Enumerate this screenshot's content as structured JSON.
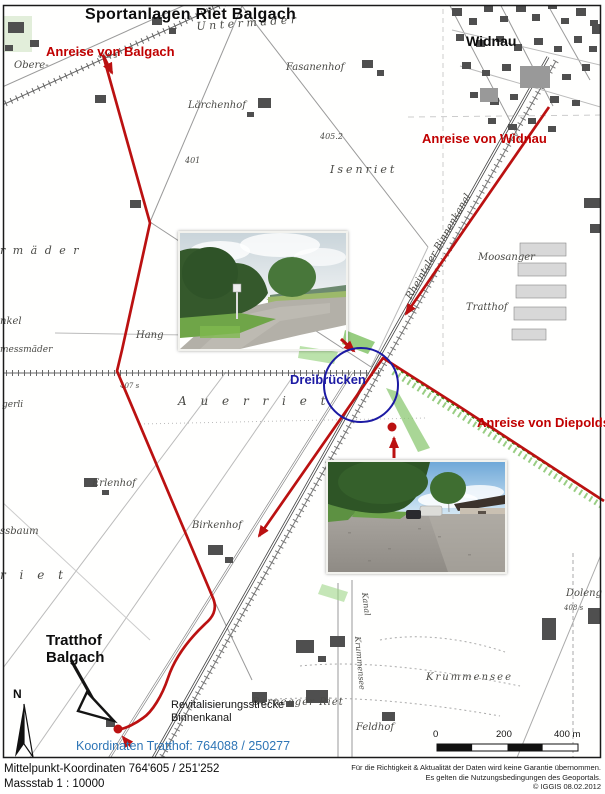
{
  "title": "Sportanlagen Riet Balgach",
  "annotations": {
    "anreise_balgach": "Anreise von Balgach",
    "anreise_widnau": "Anreise von Widnau",
    "anreise_diepoldsau": "Anreise von Diepoldsau",
    "widnau": "Widnau",
    "dreibruecken": "Dreibrücken",
    "tratthof_line1": "Tratthof",
    "tratthof_line2": "Balgach",
    "revital_line1": "Revitalisierungsstrecke",
    "revital_line2": "Binnenkanal",
    "koordinaten_tratthof": "Koordinaten Tratthof: 764088 / 250277",
    "compass": "N"
  },
  "scale_bar": {
    "tick_0": "0",
    "tick_200": "200",
    "tick_400": "400 m"
  },
  "footer": {
    "center_coordinates": "Mittelpunkt-Koordinaten 764'605 / 251'252",
    "scale": "Massstab 1 : 10000",
    "disclaimer_line1": "Für die Richtigkeit & Aktualität der Daten wird keine Garantie übernommen.",
    "disclaimer_line2": "Es gelten die Nutzungsbedingungen des Geoportals.",
    "credit": "© IGGIS  08.02.2012"
  },
  "colors": {
    "route_red": "#bb1111",
    "label_red": "#c00000",
    "circle_blue": "#1c1aa3",
    "coordinates_blue": "#2e75b6"
  },
  "map_labels": [
    {
      "t": "U n t e r m ä d e r",
      "x": 196,
      "y": 20,
      "s": 11,
      "r": -4
    },
    {
      "t": "Obere-",
      "x": 14,
      "y": 60,
      "s": 10
    },
    {
      "t": "Fasanenhof",
      "x": 286,
      "y": 62,
      "s": 10
    },
    {
      "t": "Lärchenhof",
      "x": 188,
      "y": 100,
      "s": 10
    },
    {
      "t": "Isenriet",
      "x": 330,
      "y": 163,
      "s": 11,
      "ls": 3
    },
    {
      "t": "r m ä d e r",
      "x": 0,
      "y": 244,
      "s": 11,
      "ls": 2
    },
    {
      "t": "nkel",
      "x": 0,
      "y": 316,
      "s": 10
    },
    {
      "t": "messmäder",
      "x": 0,
      "y": 345,
      "s": 9
    },
    {
      "t": "Hang",
      "x": 136,
      "y": 330,
      "s": 10
    },
    {
      "t": "gerli",
      "x": 2,
      "y": 400,
      "s": 9
    },
    {
      "t": "A u e r r i e t",
      "x": 178,
      "y": 394,
      "s": 12,
      "ls": 5
    },
    {
      "t": "Moosanger",
      "x": 478,
      "y": 252,
      "s": 10
    },
    {
      "t": "Tratthof",
      "x": 466,
      "y": 302,
      "s": 10
    },
    {
      "t": "Rheintaler Binnenkanal",
      "x": 404,
      "y": 296,
      "s": 10,
      "r": -60
    },
    {
      "t": "Erlenhof",
      "x": 92,
      "y": 478,
      "s": 10
    },
    {
      "t": "ssbaum",
      "x": 0,
      "y": 526,
      "s": 10
    },
    {
      "t": "Birkenhof",
      "x": 192,
      "y": 520,
      "s": 10
    },
    {
      "t": "r i e t",
      "x": 0,
      "y": 568,
      "s": 12,
      "ls": 5
    },
    {
      "t": "Krummensee",
      "x": 426,
      "y": 672,
      "s": 10,
      "ls": 2
    },
    {
      "t": "Doleng",
      "x": 566,
      "y": 588,
      "s": 10
    },
    {
      "t": "Bernegger  Riet",
      "x": 252,
      "y": 697,
      "s": 10,
      "ls": 1
    },
    {
      "t": "Feldhof",
      "x": 356,
      "y": 722,
      "s": 10
    },
    {
      "t": "Kanal",
      "x": 369,
      "y": 592,
      "s": 8,
      "r": 83
    },
    {
      "t": "Krummensee",
      "x": 362,
      "y": 636,
      "s": 8,
      "r": 85
    },
    {
      "t": "406 s",
      "x": 98,
      "y": 52,
      "s": 7
    },
    {
      "t": "401",
      "x": 185,
      "y": 156,
      "s": 8
    },
    {
      "t": "405.2",
      "x": 320,
      "y": 132,
      "s": 8
    },
    {
      "t": "407 s",
      "x": 120,
      "y": 382,
      "s": 7
    },
    {
      "t": "408 s",
      "x": 564,
      "y": 604,
      "s": 7
    }
  ]
}
